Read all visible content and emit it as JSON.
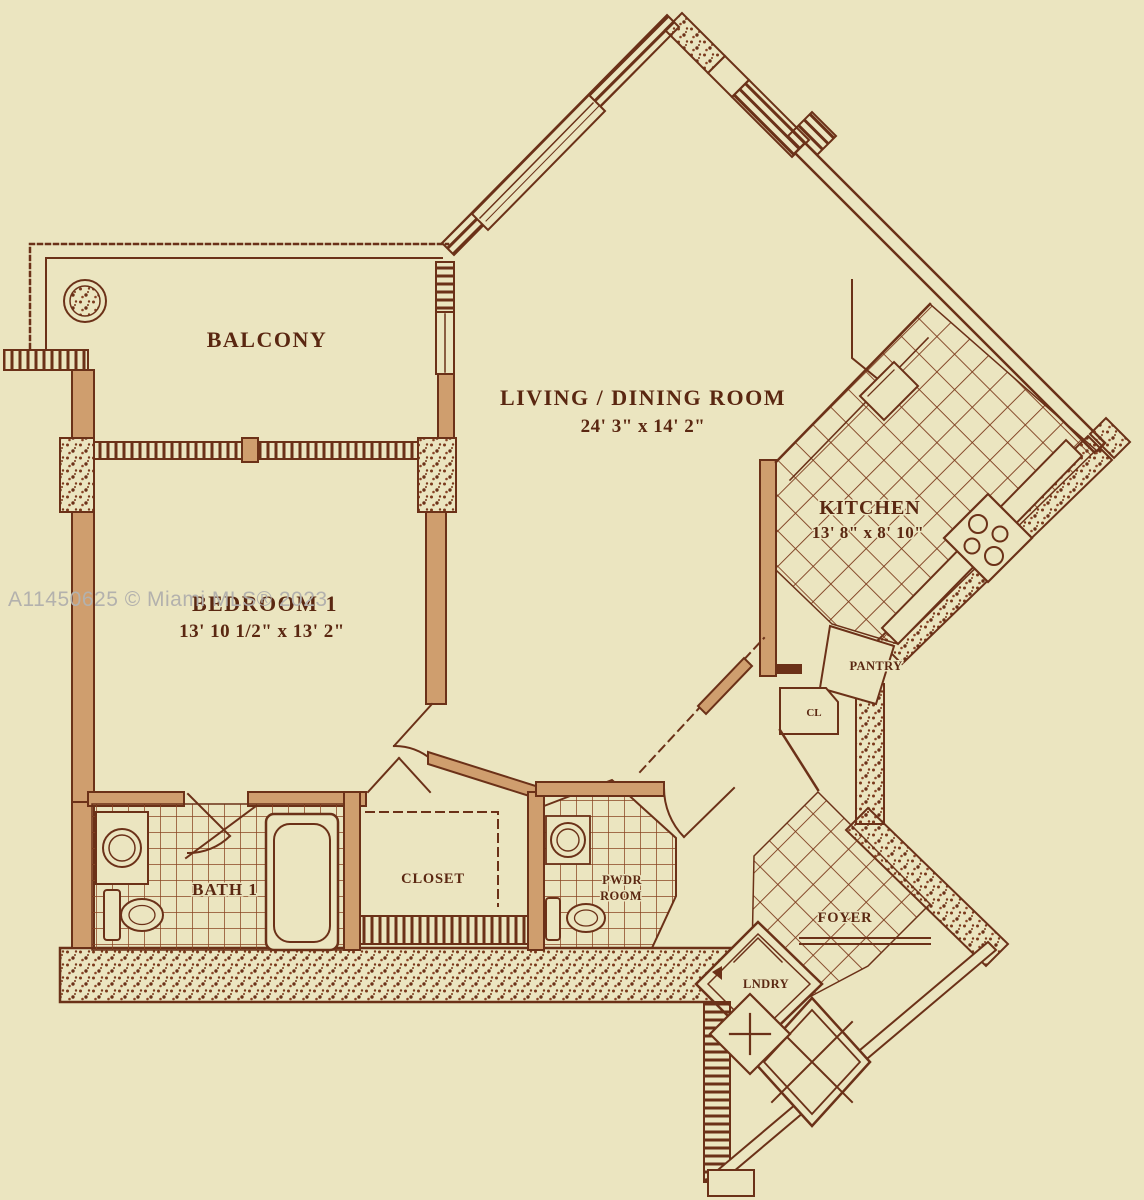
{
  "watermark": "A11450625 © Miami MLS® 2023",
  "rooms": {
    "balcony": {
      "label": "BALCONY"
    },
    "living_dining": {
      "label": "LIVING / DINING ROOM",
      "dimensions": "24' 3\" x 14' 2\""
    },
    "kitchen": {
      "label": "KITCHEN",
      "dimensions": "13' 8\" x 8' 10\""
    },
    "bedroom_1": {
      "label": "BEDROOM 1",
      "dimensions": "13' 10 1/2\" x 13' 2\""
    },
    "bath_1": {
      "label": "BATH 1"
    },
    "closet": {
      "label": "CLOSET"
    },
    "powder_room": {
      "line1": "PWDR",
      "line2": "ROOM"
    },
    "pantry": {
      "label": "PANTRY"
    },
    "closet_small": {
      "label": "CL"
    },
    "foyer": {
      "label": "FOYER"
    },
    "laundry": {
      "label": "LNDRY"
    }
  },
  "colors": {
    "background": "#ebe5c0",
    "line": "#6b3118",
    "wall_fill": "#cf9e6e",
    "watermark": "#b3b1ad"
  }
}
